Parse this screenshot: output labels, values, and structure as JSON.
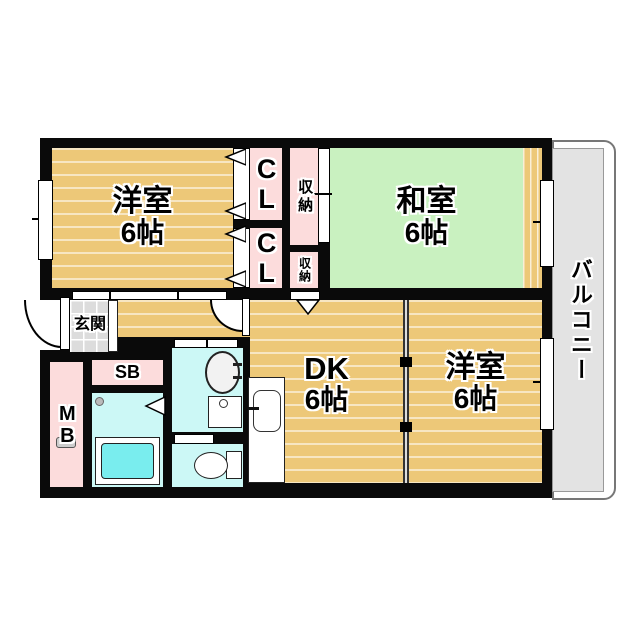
{
  "floorplan": {
    "rooms": {
      "western_tl": {
        "name": "洋室",
        "size": "6帖"
      },
      "japanese": {
        "name": "和室",
        "size": "6帖"
      },
      "dk": {
        "name": "DK",
        "size": "6帖"
      },
      "western_br": {
        "name": "洋室",
        "size": "6帖"
      }
    },
    "areas": {
      "balcony": {
        "label": "バルコニー"
      },
      "entrance": {
        "label": "玄関"
      },
      "closet_upper": {
        "label": "CL"
      },
      "closet_lower": {
        "label": "CL"
      },
      "storage_upper": {
        "label": "収納"
      },
      "storage_lower": {
        "label": "収納"
      },
      "shoe_box": {
        "label": "SB"
      },
      "meter_box": {
        "label": "MB"
      }
    },
    "colors": {
      "wall": "#0a0a0a",
      "wood": "#edc878",
      "tatami": "#c9f1c0",
      "closet-pink": "#fcdcdc",
      "wet-cyan": "#ccf8f6",
      "tub-cyan": "#79edee",
      "balcony-gray": "#e3e3e3",
      "tile-gray": "#dcdcdc"
    }
  }
}
